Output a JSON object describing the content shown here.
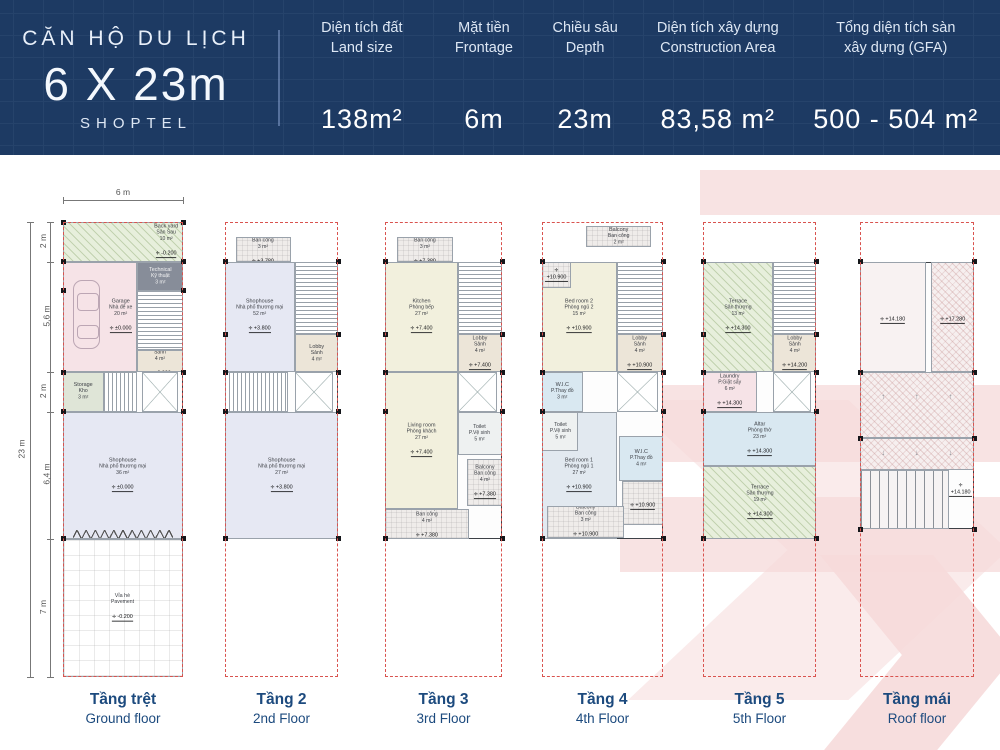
{
  "header": {
    "title_small": "CĂN HỘ DU LỊCH",
    "title_big": "6 X 23m",
    "subtitle": "SHOPTEL",
    "specs": [
      {
        "key": "land-size",
        "l1": "Diện tích đất",
        "l2": "Land size",
        "value": "138m²",
        "flex": 20
      },
      {
        "key": "frontage",
        "l1": "Mặt tiền",
        "l2": "Frontage",
        "value": "6m",
        "flex": 15
      },
      {
        "key": "depth",
        "l1": "Chiều sâu",
        "l2": "Depth",
        "value": "23m",
        "flex": 14
      },
      {
        "key": "construction-area",
        "l1": "Diện tích xây dựng",
        "l2": "Construction Area",
        "value": "83,58 m²",
        "flex": 24
      },
      {
        "key": "gfa",
        "l1": "Tổng diện tích sàn",
        "l2": "xây dựng (GFA)",
        "value": "500 - 504 m²",
        "flex": 27
      }
    ]
  },
  "colors": {
    "header_bg": "#1d3a63",
    "floor_label": "#1c4a7e",
    "lot_dash": "#d9534f",
    "watermark": "#f6dada"
  },
  "dimensions": {
    "top_width": "6 m",
    "overall": "23 m",
    "segments": [
      {
        "label": "2 m",
        "from": 0,
        "to": 8.7
      },
      {
        "label": "5,6 m",
        "from": 8.7,
        "to": 33.0
      },
      {
        "label": "2 m",
        "from": 33.0,
        "to": 41.7
      },
      {
        "label": "6,4 m",
        "from": 41.7,
        "to": 69.6
      },
      {
        "label": "7 m",
        "from": 69.6,
        "to": 100
      }
    ]
  },
  "floors": [
    {
      "key": "ground",
      "label_vi": "Tầng trệt",
      "label_en": "Ground floor",
      "x": 63,
      "w": 120,
      "built": [
        0,
        69.6
      ],
      "piers": [
        0,
        8.7,
        15,
        33,
        41.7,
        69.6
      ],
      "rooms": [
        {
          "n": "backyard",
          "rect": [
            0,
            0,
            100,
            8.7
          ],
          "cls": "green lab-r",
          "lines": [
            "Back yard",
            "Sân Sau",
            "10 m²"
          ],
          "level": "-0.200"
        },
        {
          "n": "garage",
          "rect": [
            0,
            8.7,
            62,
            24.3
          ],
          "cls": "pink lab-r",
          "lines": [
            "Garage",
            "Nhà để xe",
            "20 m²"
          ],
          "level": "±0.000",
          "icon": "car"
        },
        {
          "n": "technical",
          "rect": [
            62,
            8.7,
            38,
            6.4
          ],
          "cls": "dark white-t",
          "lines": [
            "Technical",
            "Kỹ thuật",
            "3 m²"
          ]
        },
        {
          "n": "stair-main",
          "rect": [
            62,
            15.1,
            38,
            13.1
          ],
          "cls": "stairsV"
        },
        {
          "n": "lobby",
          "rect": [
            62,
            28.2,
            38,
            4.8
          ],
          "cls": "tan",
          "lines": [
            "Lobby",
            "Sảnh",
            "4 m²"
          ],
          "level": "+0.000"
        },
        {
          "n": "storage",
          "rect": [
            0,
            33,
            34,
            8.7
          ],
          "cls": "sage",
          "lines": [
            "Storage",
            "Kho",
            "3 m²"
          ]
        },
        {
          "n": "stair-mid",
          "rect": [
            34,
            33,
            28,
            8.7
          ],
          "cls": "stairsH"
        },
        {
          "n": "elevator",
          "rect": [
            66,
            33,
            30,
            8.7
          ],
          "cls": "elev"
        },
        {
          "n": "shophouse",
          "rect": [
            0,
            41.7,
            100,
            27.9
          ],
          "cls": "lav",
          "lines": [
            "Shophouse",
            "Nhà phố thương mại",
            "36 m²"
          ],
          "level": "±0.000",
          "shopfront": true
        },
        {
          "n": "pavement",
          "rect": [
            0,
            69.6,
            100,
            30.4
          ],
          "cls": "pave",
          "lines": [
            "Vỉa hè",
            "Pavement"
          ],
          "level": "-0.200"
        }
      ]
    },
    {
      "key": "2",
      "label_vi": "Tầng 2",
      "label_en": "2nd Floor",
      "x": 225,
      "w": 113,
      "built": [
        8.7,
        69.6
      ],
      "piers": [
        8.7,
        24.7,
        33,
        41.7,
        69.6
      ],
      "rooms": [
        {
          "n": "balcony-back",
          "rect": [
            10,
            3.2,
            48,
            5.5
          ],
          "cls": "balc",
          "lines": [
            "Balcony",
            "Ban công",
            "3 m²"
          ],
          "level": "+3.780"
        },
        {
          "n": "shophouse-upper",
          "rect": [
            0,
            8.7,
            62,
            24.3
          ],
          "cls": "lav",
          "lines": [
            "Shophouse",
            "Nhà phố thương mại",
            "52 m²"
          ],
          "level": "+3.800"
        },
        {
          "n": "stair-main",
          "rect": [
            62,
            8.7,
            38,
            16
          ],
          "cls": "stairsV"
        },
        {
          "n": "lobby",
          "rect": [
            62,
            24.7,
            38,
            8.3
          ],
          "cls": "tan",
          "lines": [
            "Lobby",
            "Sảnh",
            "4 m²"
          ]
        },
        {
          "n": "stair-mid",
          "rect": [
            0,
            33,
            56,
            8.7
          ],
          "cls": "stairsH"
        },
        {
          "n": "elevator",
          "rect": [
            62,
            33,
            34,
            8.7
          ],
          "cls": "elev"
        },
        {
          "n": "shophouse-lower",
          "rect": [
            0,
            41.7,
            100,
            27.9
          ],
          "cls": "lav",
          "lines": [
            "Shophouse",
            "Nhà phố thương mại",
            "27 m²"
          ],
          "level": "+3.800"
        }
      ]
    },
    {
      "key": "3",
      "label_vi": "Tầng 3",
      "label_en": "3rd Floor",
      "x": 385,
      "w": 117,
      "built": [
        8.7,
        69.6
      ],
      "piers": [
        8.7,
        24.7,
        33,
        41.7,
        69.6
      ],
      "rooms": [
        {
          "n": "balcony-back",
          "rect": [
            10,
            3.2,
            48,
            5.5
          ],
          "cls": "balc",
          "lines": [
            "Balcony",
            "Ban công",
            "3 m²"
          ],
          "level": "+7.380"
        },
        {
          "n": "kitchen",
          "rect": [
            0,
            8.7,
            62,
            24.3
          ],
          "cls": "cream",
          "lines": [
            "Kitchen",
            "Phòng bếp",
            "27 m²"
          ],
          "level": "+7.400"
        },
        {
          "n": "stair-main",
          "rect": [
            62,
            8.7,
            38,
            16
          ],
          "cls": "stairsV"
        },
        {
          "n": "lobby",
          "rect": [
            62,
            24.7,
            38,
            8.3
          ],
          "cls": "tan",
          "lines": [
            "Lobby",
            "Sảnh",
            "4 m²"
          ],
          "level": "+7.400"
        },
        {
          "n": "elevator",
          "rect": [
            62,
            33,
            34,
            8.7
          ],
          "cls": "elev"
        },
        {
          "n": "living-room",
          "rect": [
            0,
            33,
            62,
            30
          ],
          "cls": "cream",
          "lines": [
            "Living room",
            "Phòng khách",
            "27 m²"
          ],
          "level": "+7.400"
        },
        {
          "n": "toilet",
          "rect": [
            62,
            41.7,
            38,
            9.4
          ],
          "cls": "toil",
          "lines": [
            "Toilet",
            "P.Vệ sinh",
            "5 m²"
          ]
        },
        {
          "n": "balcony-side",
          "rect": [
            70,
            52,
            30,
            10.5
          ],
          "cls": "balc",
          "lines": [
            "Balcony",
            "Ban công",
            "4 m²"
          ],
          "level": "+7.380"
        },
        {
          "n": "balcony-front",
          "rect": [
            0,
            63,
            72,
            6.6
          ],
          "cls": "balc",
          "lines": [
            "Balcony",
            "Ban công",
            "4 m²"
          ],
          "level": "+7.380"
        }
      ]
    },
    {
      "key": "4",
      "label_vi": "Tầng 4",
      "label_en": "4th Floor",
      "x": 542,
      "w": 121,
      "built": [
        8.7,
        69.6
      ],
      "piers": [
        8.7,
        24.7,
        33,
        41.7,
        69.6
      ],
      "rooms": [
        {
          "n": "balcony-top",
          "rect": [
            36,
            0.8,
            54,
            4.6
          ],
          "cls": "balc",
          "lines": [
            "Balcony",
            "Ban công",
            "2 m²"
          ]
        },
        {
          "n": "bedroom-2",
          "rect": [
            0,
            8.7,
            62,
            24.3
          ],
          "cls": "cream",
          "lines": [
            "Bed room 2",
            "Phòng ngủ 2",
            "15 m²"
          ],
          "level": "+10.900"
        },
        {
          "n": "balcony-back",
          "rect": [
            0,
            8.7,
            24,
            5.8
          ],
          "cls": "balc",
          "lines": [],
          "level": "+10.900"
        },
        {
          "n": "stair-main",
          "rect": [
            62,
            8.7,
            38,
            16
          ],
          "cls": "stairsV"
        },
        {
          "n": "lobby",
          "rect": [
            62,
            24.7,
            38,
            8.3
          ],
          "cls": "tan",
          "lines": [
            "Lobby",
            "Sảnh",
            "4 m²"
          ],
          "level": "+10.900"
        },
        {
          "n": "wic-small",
          "rect": [
            0,
            33,
            34,
            8.7
          ],
          "cls": "blue",
          "lines": [
            "W.I.C",
            "P.Thay đồ",
            "3 m²"
          ]
        },
        {
          "n": "elevator",
          "rect": [
            62,
            33,
            34,
            8.7
          ],
          "cls": "elev"
        },
        {
          "n": "bedroom-1",
          "rect": [
            0,
            41.7,
            62,
            27.9
          ],
          "cls": "bgrey",
          "lines": [
            "Bed room 1",
            "Phòng ngủ 1",
            "27 m²"
          ],
          "level": "+10.900"
        },
        {
          "n": "toilet",
          "rect": [
            0,
            41.7,
            30,
            8.6
          ],
          "cls": "toil",
          "lines": [
            "Toilet",
            "P.Vệ sinh",
            "5 m²"
          ]
        },
        {
          "n": "wic",
          "rect": [
            64,
            47,
            36,
            10
          ],
          "cls": "blue",
          "lines": [
            "W.I.C",
            "P.Thay đồ",
            "4 m²"
          ]
        },
        {
          "n": "balcony-side",
          "rect": [
            66,
            57,
            34,
            9.6
          ],
          "cls": "balc",
          "lines": [],
          "level": "+10.900"
        },
        {
          "n": "balcony-front",
          "rect": [
            4,
            62.5,
            64,
            7
          ],
          "cls": "balc",
          "lines": [
            "Balcony",
            "Ban công",
            "3 m²"
          ],
          "level": "+10.900"
        }
      ]
    },
    {
      "key": "5",
      "label_vi": "Tầng 5",
      "label_en": "5th Floor",
      "x": 703,
      "w": 113,
      "built": [
        8.7,
        69.6
      ],
      "piers": [
        8.7,
        24.7,
        33,
        41.7,
        69.6
      ],
      "rooms": [
        {
          "n": "terrace-back",
          "rect": [
            0,
            8.7,
            62,
            24.3
          ],
          "cls": "green",
          "lines": [
            "Terrace",
            "Sân thượng",
            "13 m²"
          ],
          "level": "+14.300"
        },
        {
          "n": "stair-main",
          "rect": [
            62,
            8.7,
            38,
            16
          ],
          "cls": "stairsV"
        },
        {
          "n": "lobby",
          "rect": [
            62,
            24.7,
            38,
            8.3
          ],
          "cls": "tan",
          "lines": [
            "Lobby",
            "Sảnh",
            "4 m²"
          ],
          "level": "+14.200"
        },
        {
          "n": "laundry",
          "rect": [
            0,
            33,
            48,
            8.7
          ],
          "cls": "pink",
          "lines": [
            "Laundry",
            "P.Giặt sấy",
            "6 m²"
          ],
          "level": "+14.300"
        },
        {
          "n": "elevator",
          "rect": [
            62,
            33,
            34,
            8.7
          ],
          "cls": "elev"
        },
        {
          "n": "altar",
          "rect": [
            0,
            41.7,
            100,
            12
          ],
          "cls": "blue",
          "lines": [
            "Altar",
            "Phòng thờ",
            "23 m²"
          ],
          "level": "+14.300"
        },
        {
          "n": "terrace-front",
          "rect": [
            0,
            53.7,
            100,
            15.9
          ],
          "cls": "green",
          "lines": [
            "Terrace",
            "Sân thượng",
            "19 m²"
          ],
          "level": "+14.300"
        }
      ]
    },
    {
      "key": "roof",
      "label_vi": "Tầng mái",
      "label_en": "Roof floor",
      "x": 860,
      "w": 114,
      "built": [
        8.7,
        67.5
      ],
      "piers": [
        8.7,
        33,
        47.5,
        67.5
      ],
      "rooms": [
        {
          "n": "roof-deck",
          "rect": [
            0,
            8.7,
            58,
            24.3
          ],
          "cls": "deck",
          "lines": [],
          "level": "+14.180"
        },
        {
          "n": "roof-stair-top",
          "rect": [
            62,
            8.7,
            38,
            24.3
          ],
          "cls": "roofh",
          "lines": [],
          "level": "+17.280"
        },
        {
          "n": "roof-slope-upper",
          "rect": [
            0,
            33,
            100,
            14.5
          ],
          "cls": "roofh",
          "arrows": "↑"
        },
        {
          "n": "roof-slope-lower",
          "rect": [
            0,
            47.5,
            100,
            7
          ],
          "cls": "roofh",
          "arrows": "↓"
        },
        {
          "n": "pergola",
          "rect": [
            0,
            54.5,
            78,
            13
          ],
          "cls": "slats"
        },
        {
          "n": "roof-deck-level",
          "rect": [
            76,
            56,
            24,
            6
          ],
          "cls": "none",
          "lines": [],
          "level": "+14.180"
        }
      ]
    }
  ]
}
